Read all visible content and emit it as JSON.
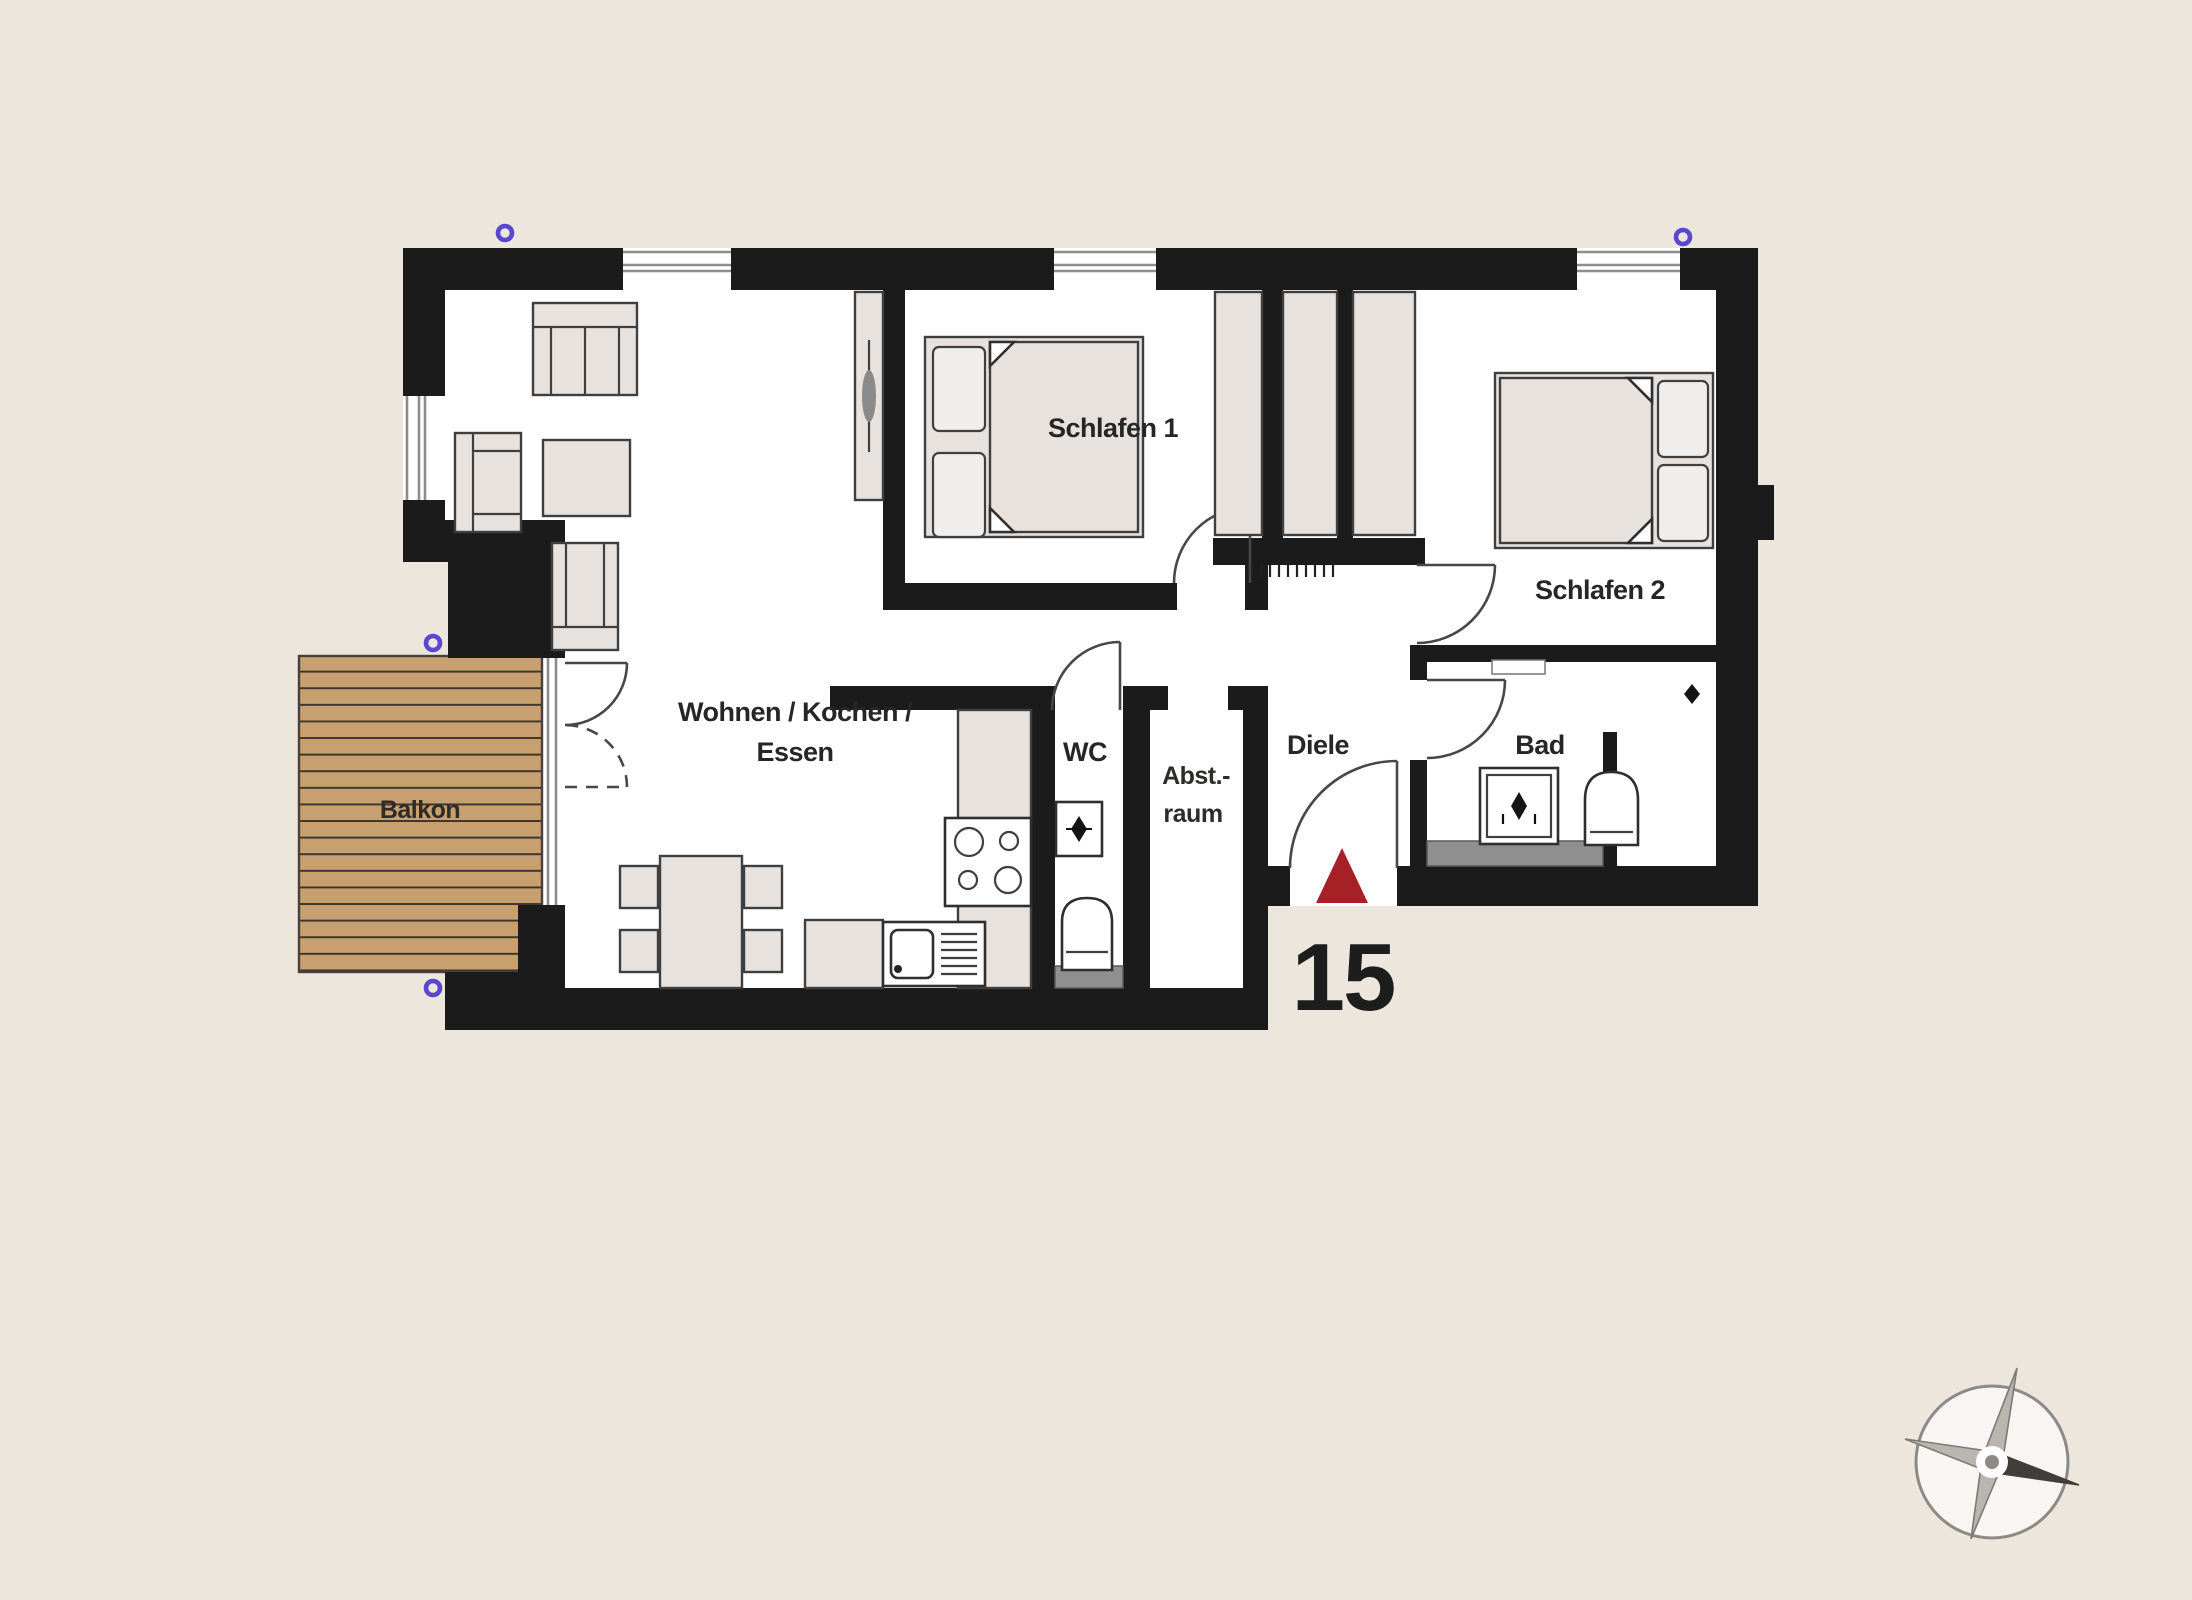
{
  "floorplan": {
    "unit_number": "15",
    "rooms": {
      "schlafen1": "Schlafen 1",
      "schlafen2": "Schlafen 2",
      "wohnen_line1": "Wohnen / Kochen /",
      "wohnen_line2": "Essen",
      "wc": "WC",
      "abst_line1": "Abst.-",
      "abst_line2": "raum",
      "diele": "Diele",
      "bad": "Bad",
      "balkon": "Balkon"
    },
    "colors": {
      "bg": "#ece6dd",
      "wall": "#1b1b1b",
      "fill": "#e7e2de",
      "wood": "#c89f6f",
      "red": "#a62125",
      "purple": "#5a47cf",
      "gray": "#8f8f8f"
    }
  }
}
